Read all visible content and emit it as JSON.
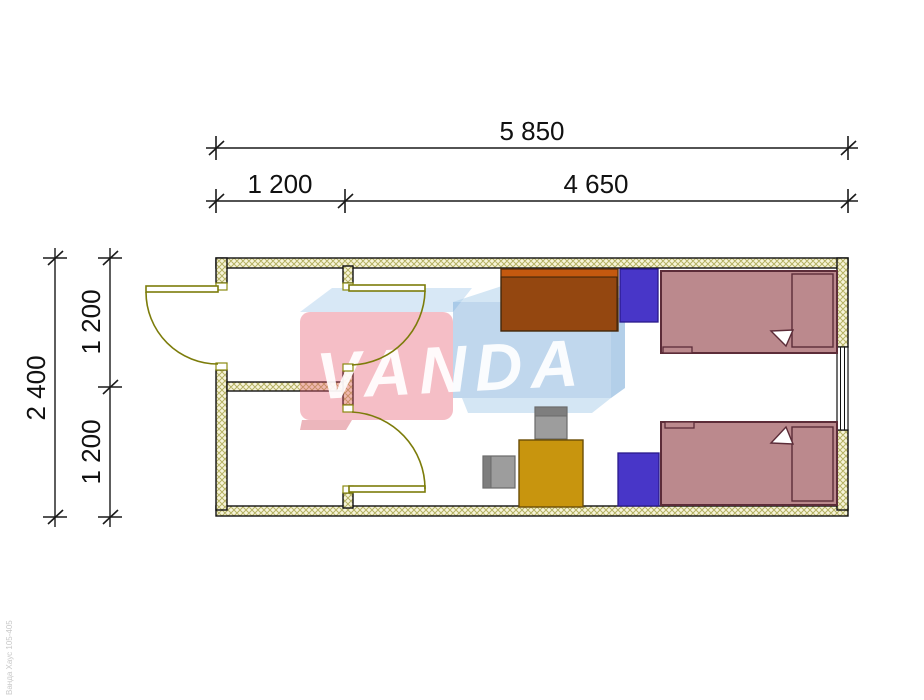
{
  "drawing": {
    "kind": "floor-plan",
    "brand": "VANDA",
    "fine_print": "Ванда Хаус 105-405"
  },
  "dimensions": {
    "top": {
      "total": "5 850",
      "segments": [
        "1 200",
        "4 650"
      ]
    },
    "left": {
      "total": "2 400",
      "segments": [
        "1 200",
        "1 200"
      ]
    }
  },
  "furniture": [
    {
      "name": "wardrobe-desk"
    },
    {
      "name": "nightstand-top"
    },
    {
      "name": "bed-top"
    },
    {
      "name": "chair-top"
    },
    {
      "name": "chair-left"
    },
    {
      "name": "table"
    },
    {
      "name": "nightstand-bottom"
    },
    {
      "name": "bed-bottom"
    }
  ],
  "colors": {
    "wall_fill": "#f7f4da",
    "wall_hatch": "#b5b263",
    "outline": "#1a1a1a",
    "door": "#7c7c0a",
    "bed": "#bb898d",
    "bed_outline": "#5c2c38",
    "desk_orange": "#c4590f",
    "desk_brown": "#503014",
    "nightstand_blue": "#4836c8",
    "nightstand_outline": "#2a1a8a",
    "table_gold": "#c8950e",
    "table_outline": "#6b4e07",
    "chair_gray": "#9d9d9d",
    "chair_dark": "#7e7e7e",
    "wm_pink": "#e55c70",
    "wm_pink_dark": "#d04858",
    "wm_blue": "#68a0d4",
    "wm_blue_light": "#a9cdea",
    "wm_text": "#ffffff"
  }
}
